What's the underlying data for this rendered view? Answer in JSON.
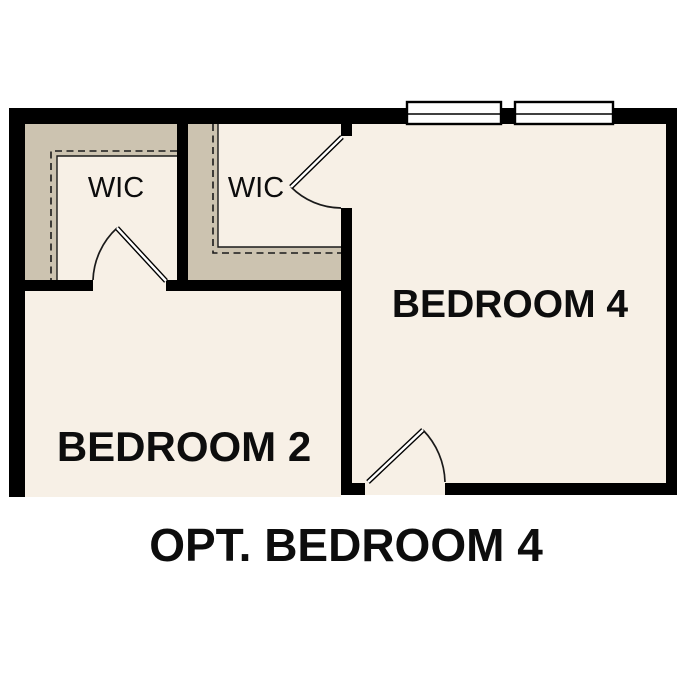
{
  "plan": {
    "caption": "OPT. BEDROOM 4",
    "rooms": {
      "wic1": {
        "label": "WIC"
      },
      "wic2": {
        "label": "WIC"
      },
      "bedroom2": {
        "label": "BEDROOM 2"
      },
      "bedroom4": {
        "label": "BEDROOM 4"
      }
    },
    "features": {
      "window_count": "2",
      "door_count": "3"
    }
  },
  "colors": {
    "wall": "#000000",
    "floor": "#f7f0e6",
    "closet_wall": "#ccc3b0",
    "window_fill": "#ffffff",
    "background": "#ffffff",
    "line": "#1a1a1a"
  }
}
